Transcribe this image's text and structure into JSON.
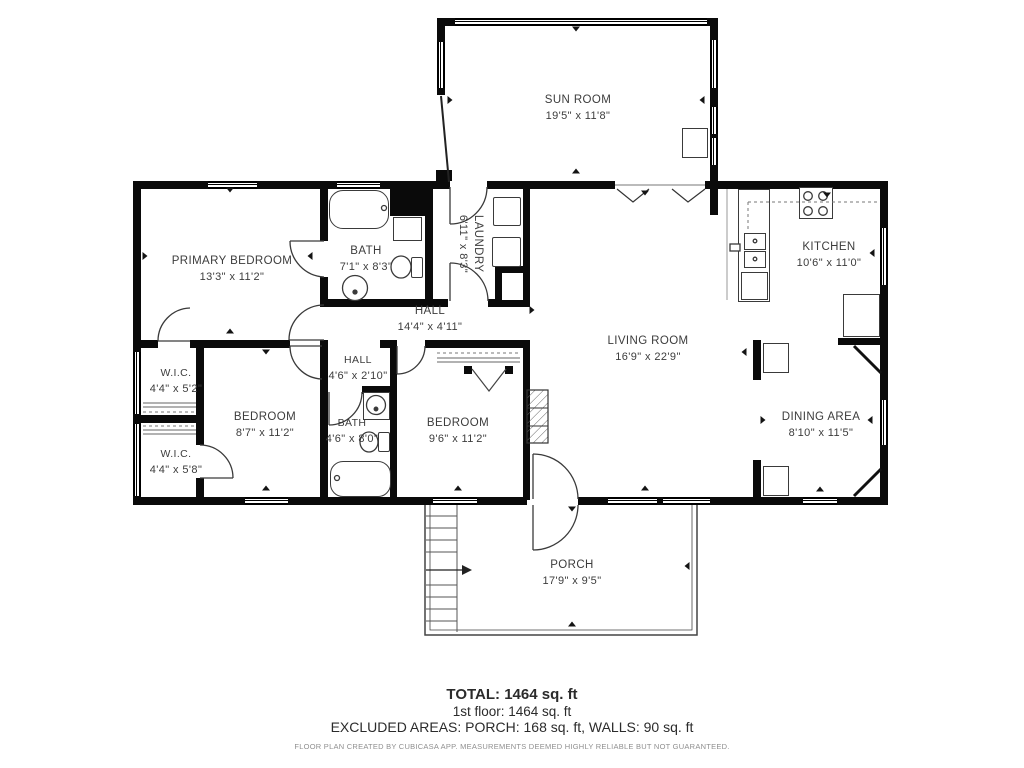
{
  "plan": {
    "rooms": [
      {
        "id": "sun-room",
        "name": "SUN ROOM",
        "dims": "19'5\" x 11'8\""
      },
      {
        "id": "primary-bedroom",
        "name": "PRIMARY BEDROOM",
        "dims": "13'3\" x 11'2\""
      },
      {
        "id": "bath-1",
        "name": "BATH",
        "dims": "7'1\" x 8'3\""
      },
      {
        "id": "laundry",
        "name": "LAUNDRY",
        "dims": "6'11\" x 8'3\""
      },
      {
        "id": "hall-1",
        "name": "HALL",
        "dims": "14'4\" x 4'11\""
      },
      {
        "id": "kitchen",
        "name": "KITCHEN",
        "dims": "10'6\" x 11'0\""
      },
      {
        "id": "living-room",
        "name": "LIVING ROOM",
        "dims": "16'9\" x 22'9\""
      },
      {
        "id": "wic-1",
        "name": "W.I.C.",
        "dims": "4'4\" x 5'2\""
      },
      {
        "id": "bedroom-2",
        "name": "BEDROOM",
        "dims": "8'7\" x 11'2\""
      },
      {
        "id": "wic-2",
        "name": "W.I.C.",
        "dims": "4'4\" x 5'8\""
      },
      {
        "id": "hall-2",
        "name": "HALL",
        "dims": "4'6\" x 2'10\""
      },
      {
        "id": "bath-2",
        "name": "BATH",
        "dims": "4'6\" x 8'0\""
      },
      {
        "id": "bedroom-3",
        "name": "BEDROOM",
        "dims": "9'6\" x 11'2\""
      },
      {
        "id": "dining-area",
        "name": "DINING AREA",
        "dims": "8'10\" x 11'5\""
      },
      {
        "id": "porch",
        "name": "PORCH",
        "dims": "17'9\" x 9'5\""
      }
    ]
  },
  "footer": {
    "total": "TOTAL: 1464 sq. ft",
    "first_floor": "1st floor: 1464 sq. ft",
    "excluded": "EXCLUDED AREAS: PORCH: 168 sq. ft, WALLS: 90 sq. ft",
    "disclaimer": "FLOOR PLAN CREATED BY CUBICASA APP. MEASUREMENTS DEEMED HIGHLY RELIABLE BUT NOT GUARANTEED."
  }
}
